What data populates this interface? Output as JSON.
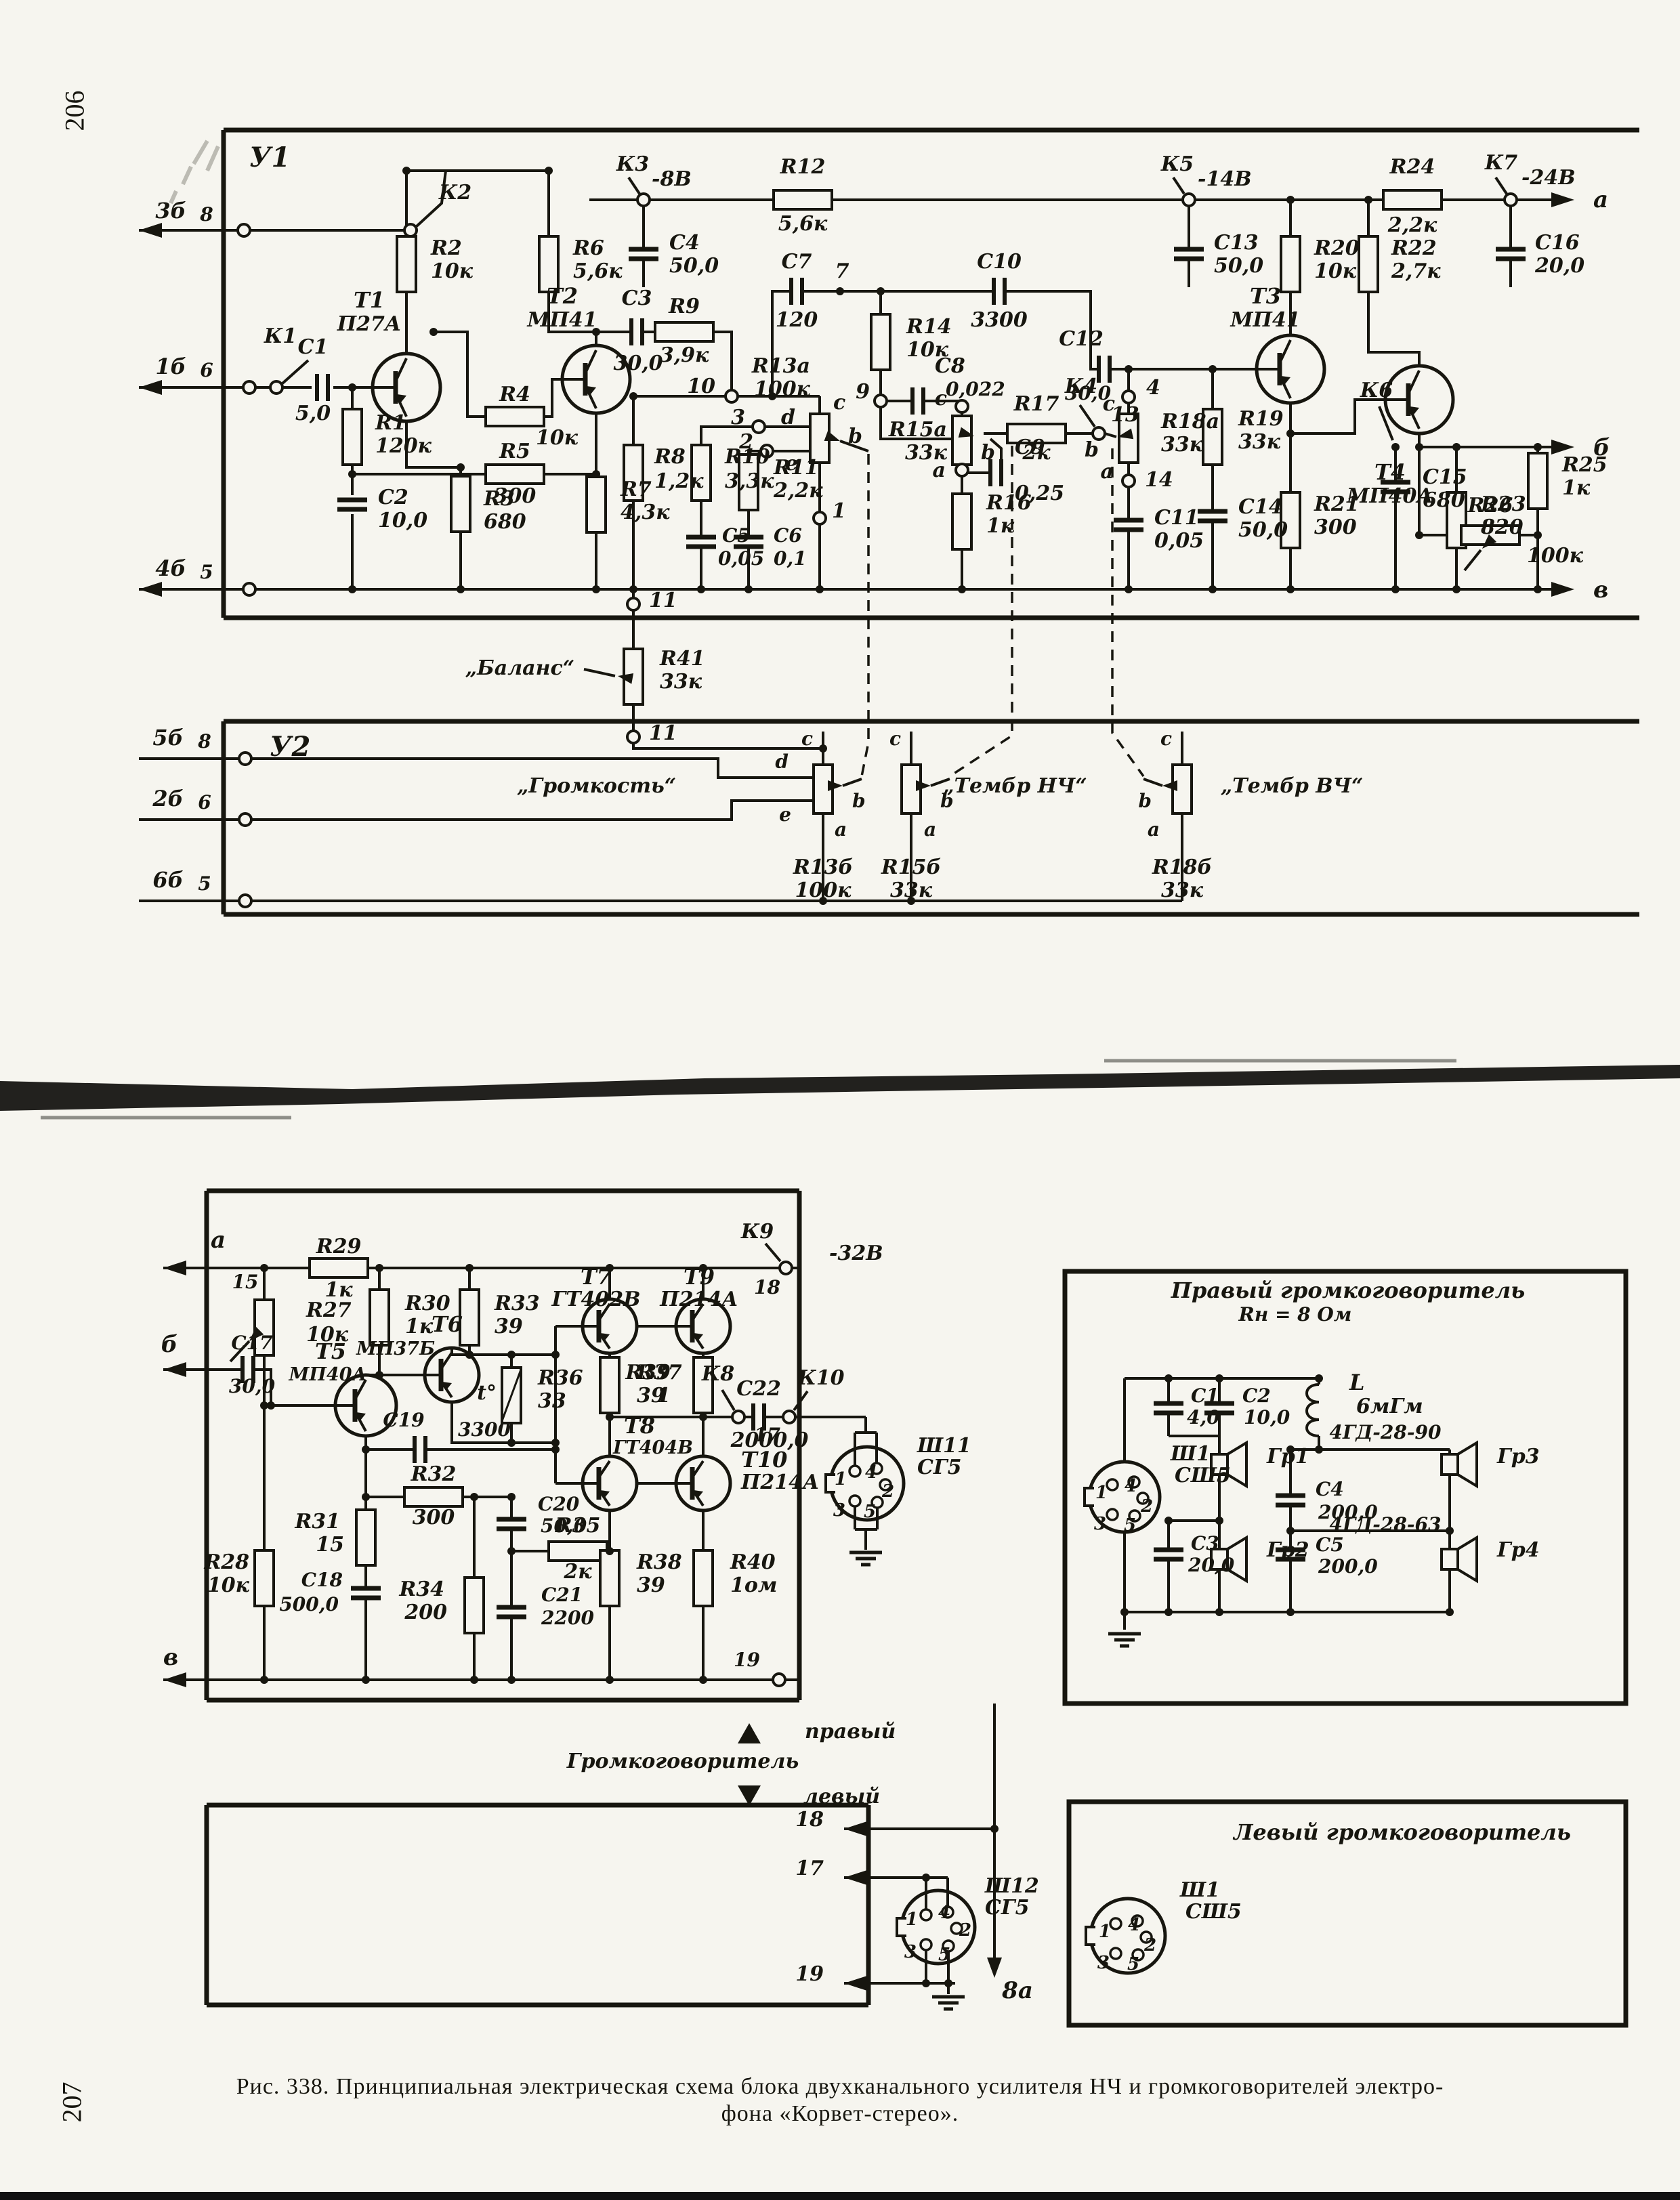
{
  "page": {
    "number_top": "206",
    "number_bottom": "207",
    "caption_line1": "Рис. 338. Принципиальная электрическая схема блока двухканального усилителя НЧ и громкоговорителей электро-",
    "caption_line2": "фона «Корвет-стерео»."
  },
  "labels": {
    "u1": "У1",
    "u2": "У2",
    "d1": "1",
    "d2": "2",
    "d3": "3",
    "d4": "4",
    "d5": "5",
    "d6": "6",
    "d7": "7",
    "d8": "8",
    "d9": "9",
    "d10": "10",
    "d11": "11",
    "d13": "13",
    "d14": "14",
    "d15": "15",
    "d17": "17",
    "d18": "18",
    "d19": "19",
    "la": "а",
    "lb": "б",
    "lv": "в",
    "lita": "a",
    "litb": "b",
    "litc": "c",
    "litd": "d",
    "lite": "e",
    "t3b": "3б",
    "t1b": "1б",
    "t4b": "4б",
    "t5b": "5б",
    "t2b": "2б",
    "t6b": "6б",
    "k1": "К1",
    "k2": "К2",
    "k3": "К3",
    "k4": "К4",
    "k5": "К5",
    "k6": "К6",
    "k7": "К7",
    "k8": "К8",
    "k9": "К9",
    "k10": "К10",
    "v8": "-8В",
    "v14": "-14В",
    "v24": "-24В",
    "v32": "-32В",
    "r1n": "R1",
    "r1v": "120к",
    "r2n": "R2",
    "r2v": "10к",
    "r3n": "R3",
    "r3v": "680",
    "r4n": "R4",
    "r4v": "10к",
    "r5n": "R5",
    "r5v": "300",
    "r6n": "R6",
    "r6v": "5,6к",
    "r7n": "R7",
    "r7v": "4,3к",
    "r8n": "R8",
    "r8v": "1,2к",
    "r9n": "R9",
    "r9v": "3,9к",
    "r10n": "R10",
    "r10v": "3,3к",
    "r11n": "R11",
    "r11v": "2,2к",
    "r12n": "R12",
    "r12v": "5,6к",
    "r13an": "R13а",
    "r13av": "100к",
    "r14n": "R14",
    "r14v": "10к",
    "r15an": "R15а",
    "r15av": "33к",
    "r16n": "R16",
    "r16v": "1к",
    "r17n": "R17",
    "r17v": "2к",
    "r18an": "R18а",
    "r18av": "33к",
    "r19n": "R19",
    "r19v": "33к",
    "r20n": "R20",
    "r20v": "10к",
    "r21n": "R21",
    "r21v": "300",
    "r22n": "R22",
    "r22v": "2,7к",
    "r23n": "R23",
    "r23v": "820",
    "r24n": "R24",
    "r24v": "2,2к",
    "r25n": "R25",
    "r25v": "1к",
    "r26n": "R26",
    "r26v": "100к",
    "r41n": "R41",
    "r41v": "33к",
    "r27n": "R27",
    "r27v": "10к",
    "r28n": "R28",
    "r28v": "10к",
    "r29n": "R29",
    "r29v": "1к",
    "r30n": "R30",
    "r30v": "1к",
    "r31n": "R31",
    "r31v": "15",
    "r32n": "R32",
    "r32v": "300",
    "r33n": "R33",
    "r33v": "39",
    "r34n": "R34",
    "r34v": "200",
    "r35n": "R35",
    "r35v": "2к",
    "r36n": "R36",
    "r36v": "33",
    "r37n": "R37",
    "r37v": "39",
    "r38n": "R38",
    "r38v": "39",
    "r39n": "R39",
    "r39v": "1",
    "r40n": "R40",
    "r40v": "1ом",
    "r13bn": "R13б",
    "r13bv": "100к",
    "r15bn": "R15б",
    "r15bv": "33к",
    "r18bn": "R18б",
    "r18bv": "33к",
    "c1n": "C1",
    "c1v": "5,0",
    "c2n": "C2",
    "c2v": "10,0",
    "c3n": "C3",
    "c3v": "30,0",
    "c4n": "C4",
    "c4v": "50,0",
    "c5n": "C5",
    "c5v": "0,05",
    "c6n": "C6",
    "c6v": "0,1",
    "c7n": "C7",
    "c7v": "120",
    "c8n": "C8",
    "c8v": "0,022",
    "c9n": "C9",
    "c9v": "0,25",
    "c10n": "C10",
    "c10v": "3300",
    "c11n": "C11",
    "c11v": "0,05",
    "c12n": "C12",
    "c12v": "30,0",
    "c13n": "C13",
    "c13v": "50,0",
    "c14n": "C14",
    "c14v": "50,0",
    "c15n": "C15",
    "c15v": "680",
    "c16n": "C16",
    "c16v": "20,0",
    "c17n": "C17",
    "c17v": "30,0",
    "c18n": "C18",
    "c18v": "500,0",
    "c19n": "C19",
    "c19v": "3300",
    "c20n": "C20",
    "c20v": "50,0",
    "c21n": "C21",
    "c21v": "2200",
    "c22n": "C22",
    "c22v": "2000,0",
    "cb1n": "C1",
    "cb1v": "4,0",
    "cb2n": "C2",
    "cb2v": "10,0",
    "cb3n": "C3",
    "cb3v": "20,0",
    "cb4n": "C4",
    "cb4v": "200,0",
    "cb5n": "C5",
    "cb5v": "200,0",
    "t1n": "Т1",
    "t1t": "П27А",
    "t2n": "Т2",
    "t2t": "МП41",
    "t3n": "Т3",
    "t3t": "МП41",
    "t4n": "Т4",
    "t4t": "МП40А",
    "t5n": "Т5",
    "t5t": "МП40А",
    "t6n": "Т6",
    "t6t": "МП37Б",
    "t7n": "Т7",
    "t7t": "ГТ402В",
    "t8n": "Т8",
    "t8t": "ГТ404В",
    "t9n": "Т9",
    "t9t": "П214А",
    "t10n": "Т10",
    "t10t": "П214А",
    "bal": "„Баланс“",
    "vol": "„Громкость“",
    "tnch": "„Тембр НЧ“",
    "tvch": "„Тембр ВЧ“",
    "legR": "правый",
    "legS": "Громкоговоритель",
    "legL": "левый",
    "n8a": "8а",
    "boxR1": "Правый громкоговоритель",
    "boxR2": "Rн = 8 Ом",
    "boxL1": "Левый громкоговоритель",
    "sh11": "Ш11",
    "sh12": "Ш12",
    "sh1": "Ш1",
    "sg5": "СГ5",
    "ssh5": "СШ5",
    "coilL": "L",
    "coilV": "6мГм",
    "gd90": "4ГД-28-90",
    "gd63": "4ГД-28-63",
    "gr1": "Гр1",
    "gr2": "Гр2",
    "gr3": "Гр3",
    "gr4": "Гр4",
    "tdeg": "t°",
    "p206": "206",
    "p207": "207",
    "cap1": "Рис. 338. Принципиальная электрическая схема блока двухканального усилителя НЧ и громкоговорителей электро-",
    "cap2": "фона «Корвет-стерео»."
  }
}
